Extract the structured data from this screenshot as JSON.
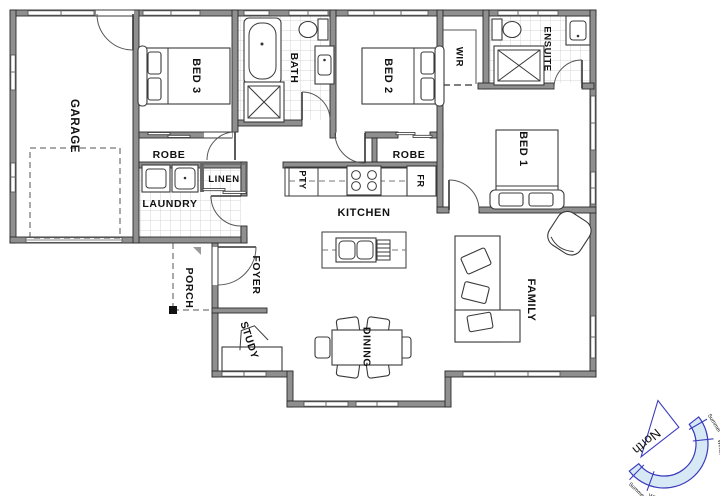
{
  "plan": {
    "rooms": {
      "garage": {
        "label": "GARAGE"
      },
      "bed3": {
        "label": "BED 3"
      },
      "robe_bed3": {
        "label": "ROBE"
      },
      "bath": {
        "label": "BATH"
      },
      "bed2": {
        "label": "BED 2"
      },
      "robe_bed2": {
        "label": "ROBE"
      },
      "wir": {
        "label": "WIR"
      },
      "ensuite": {
        "label": "ENSUITE"
      },
      "bed1": {
        "label": "BED 1"
      },
      "linen": {
        "label": "LINEN"
      },
      "laundry": {
        "label": "LAUNDRY"
      },
      "pantry": {
        "label": "PTY"
      },
      "kitchen": {
        "label": "KITCHEN"
      },
      "fridge": {
        "label": "FR"
      },
      "family": {
        "label": "FAMILY"
      },
      "porch": {
        "label": "PORCH"
      },
      "foyer": {
        "label": "FOYER"
      },
      "study": {
        "label": "STUDY"
      },
      "dining": {
        "label": "DINING"
      }
    },
    "compass": {
      "north_label": "North",
      "tick_labels": [
        "Summer",
        "Winter",
        "Winter",
        "Summer"
      ],
      "accent_color": "#3b3bbd",
      "band_fill": "#d8e9f6"
    },
    "colors": {
      "wall": "#8f8f8f",
      "wall_edge": "#2b2b2b",
      "tile_line": "#d4d4d4",
      "label_text": "#111111"
    }
  }
}
